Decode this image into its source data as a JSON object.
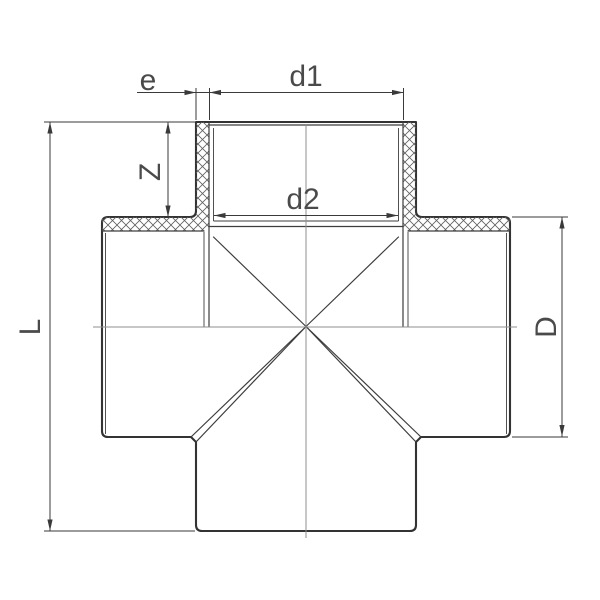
{
  "drawing": {
    "kind": "technical cross-section drawing",
    "subject": "four-way cross pipe fitting with socket ends",
    "labels": {
      "e": "e",
      "d1": "d1",
      "d2": "d2",
      "z": "Z",
      "l": "L",
      "d": "D"
    }
  },
  "colors": {
    "background": "#ffffff",
    "outline": "#333333",
    "thin_line": "#3d3d3d",
    "dimension": "#3a3a3a",
    "centerline": "#8f8f8f",
    "hatch": "#5f5f5f",
    "text": "#4a4a4a"
  }
}
